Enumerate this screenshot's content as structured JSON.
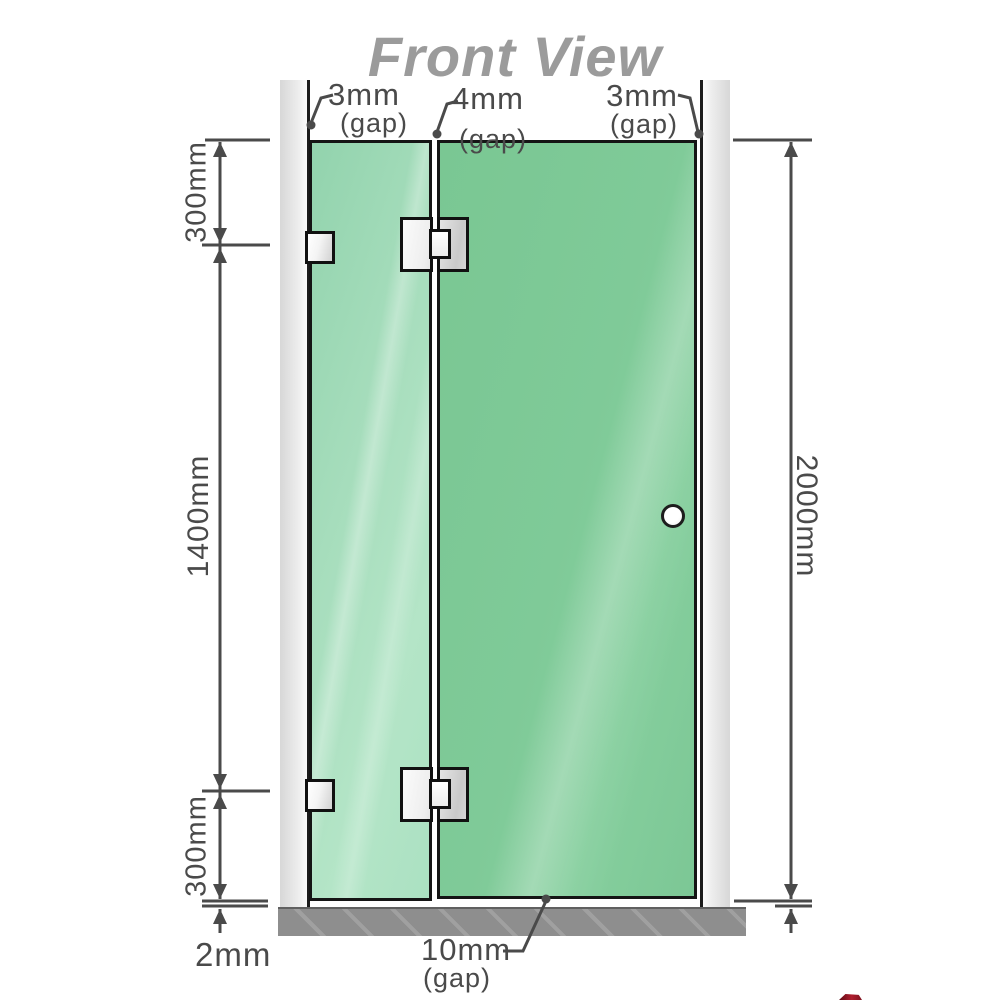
{
  "title": "Front View",
  "diagram_type": "shower-screen-front-elevation",
  "annotations": {
    "gap_top_left": {
      "value": "3mm",
      "qualifier": "(gap)"
    },
    "gap_top_middle": {
      "value": "4mm",
      "qualifier": "(gap)"
    },
    "gap_top_right": {
      "value": "3mm",
      "qualifier": "(gap)"
    },
    "side_left_top": "300mm",
    "side_left_middle": "1400mm",
    "side_left_bottom": "300mm",
    "side_right_total": "2000mm",
    "bottom_floor_gap": "2mm",
    "gap_bottom": {
      "value": "10mm",
      "qualifier": "(gap)"
    }
  },
  "colors": {
    "glass_fixed_panel": "#a9dfc0",
    "glass_door": "#7cc795",
    "wall": "#e3e3e3",
    "floor": "#8e8e8e",
    "hardware": "#e6e6e6",
    "dimension_lines": "#4a4a4a",
    "title_text": "#9b9b9b",
    "watermark_red": "#8c1622"
  }
}
